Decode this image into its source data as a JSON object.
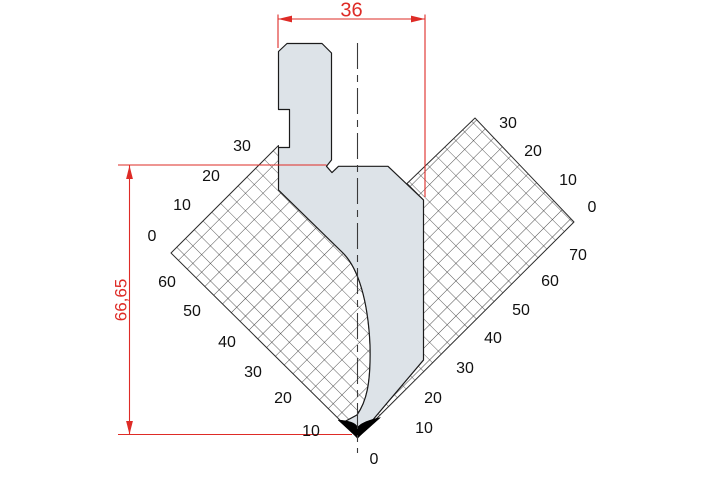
{
  "dimensions": {
    "top_width_label": "36",
    "left_height_label": "66,65"
  },
  "scales": {
    "left_upper": [
      "0",
      "10",
      "20",
      "30"
    ],
    "left_lower": [
      "60",
      "50",
      "40",
      "30",
      "20",
      "10"
    ],
    "right_lower": [
      "70",
      "60",
      "50",
      "40",
      "30",
      "20",
      "10"
    ],
    "right_upper": [
      "0",
      "10",
      "20",
      "30"
    ],
    "tip_zero": "0"
  },
  "colors": {
    "dimension_red": "#de2b26",
    "punch_fill": "#dde3e8",
    "grid_line": "#2b2b2b",
    "outline": "#1b1b1b"
  }
}
